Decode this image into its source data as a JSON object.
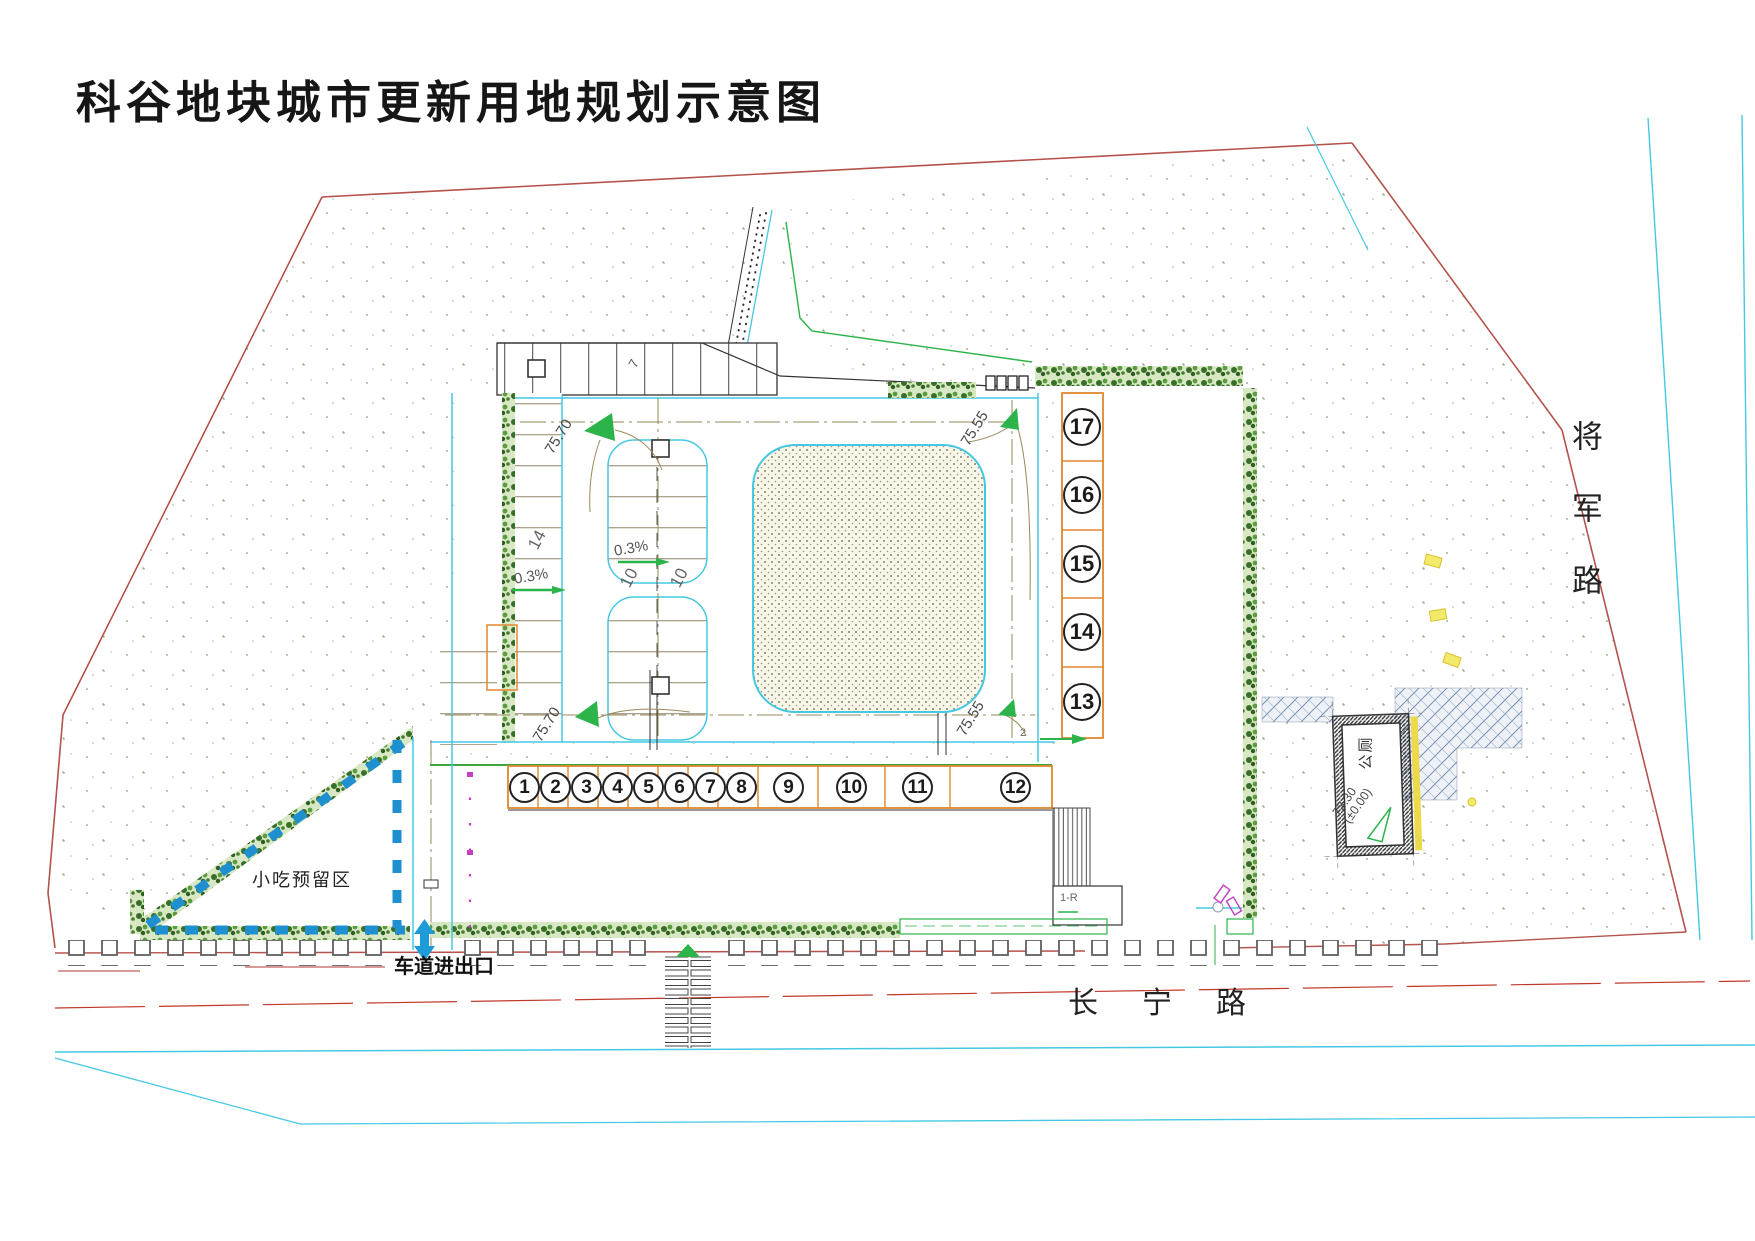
{
  "title": "科谷地块城市更新用地规划示意图",
  "roads": {
    "south": "长宁路",
    "east": "将军路"
  },
  "areas": {
    "snack_reserve": "小吃预留区",
    "toilet": "公厕"
  },
  "annotations": {
    "driveway_entrance": "车道进出口",
    "stair_label": "1-R",
    "misc_mark": "2"
  },
  "elevations": {
    "northwest": "75.70",
    "northeast": "75.55",
    "southwest": "75.70",
    "southeast": "75.55",
    "toilet_level": "73.30",
    "toilet_datum": "(±0.00)"
  },
  "slopes": {
    "west": "0.3%",
    "center": "0.3%"
  },
  "parking_counts": {
    "west_column": "14",
    "island_left": "10",
    "island_right": "10",
    "north_row": "7"
  },
  "units_row": [
    "1",
    "2",
    "3",
    "4",
    "5",
    "6",
    "7",
    "8",
    "9",
    "10",
    "11",
    "12"
  ],
  "units_col": [
    "17",
    "16",
    "15",
    "14",
    "13"
  ],
  "colors": {
    "boundary_red": "#b5524b",
    "road_cyan": "#45c8e2",
    "hedge_green": "#3a7a2a",
    "unit_box_orange": "#e0872f",
    "marker_green": "#2cb34a",
    "dash_blue": "#1e90d0",
    "gate_magenta": "#c43fc4",
    "centerline_olive": "#968a58"
  }
}
